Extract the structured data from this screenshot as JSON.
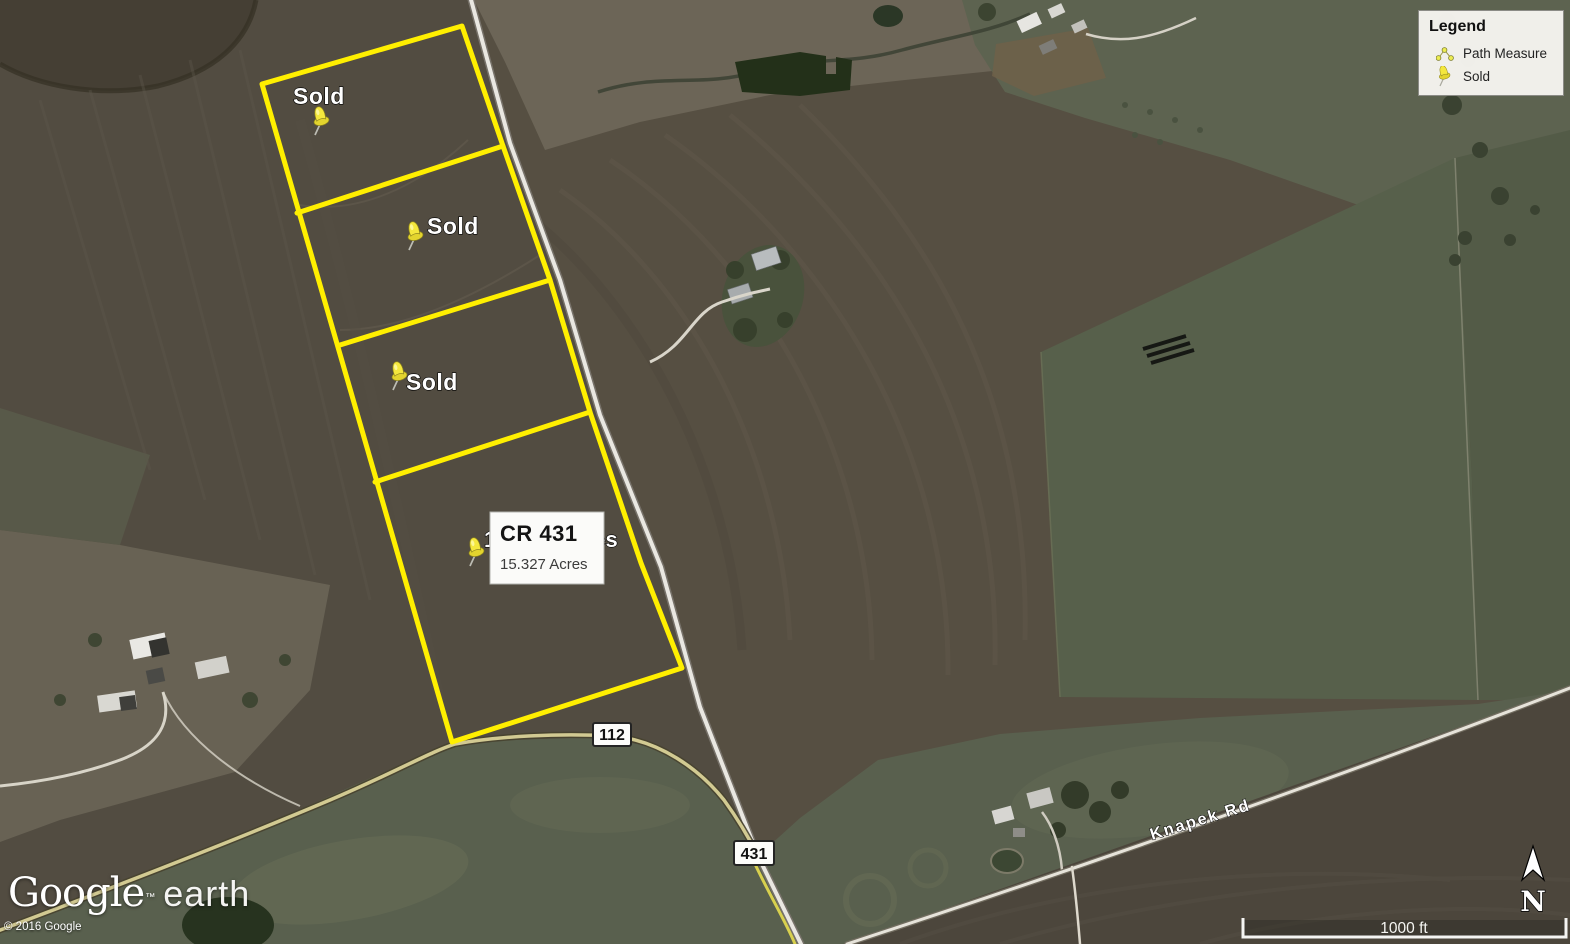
{
  "legend": {
    "title": "Legend",
    "items": [
      {
        "icon": "path-measure-icon",
        "label": "Path Measure"
      },
      {
        "icon": "sold-pushpin-icon",
        "label": "Sold"
      }
    ]
  },
  "placemarks": {
    "sold_labels": [
      "Sold",
      "Sold",
      "Sold"
    ],
    "active_parcel": {
      "title": "CR 431",
      "acreage": "15.327 Acres",
      "background_label": "15.327 Acres"
    }
  },
  "roads": {
    "badge_112": "112",
    "badge_431": "431",
    "knapek_label": "Knapek Rd"
  },
  "branding": {
    "logo_primary": "Google",
    "logo_trademark": "™",
    "logo_secondary": "earth",
    "copyright": "© 2016 Google"
  },
  "map_controls": {
    "scale_label": "1000 ft",
    "north_label": "N"
  },
  "colors": {
    "parcel_outline": "#ffef00",
    "pushpin": "#f2e63c",
    "road_highlight": "#d2ca92",
    "legend_bg": "#f4f3ef"
  }
}
